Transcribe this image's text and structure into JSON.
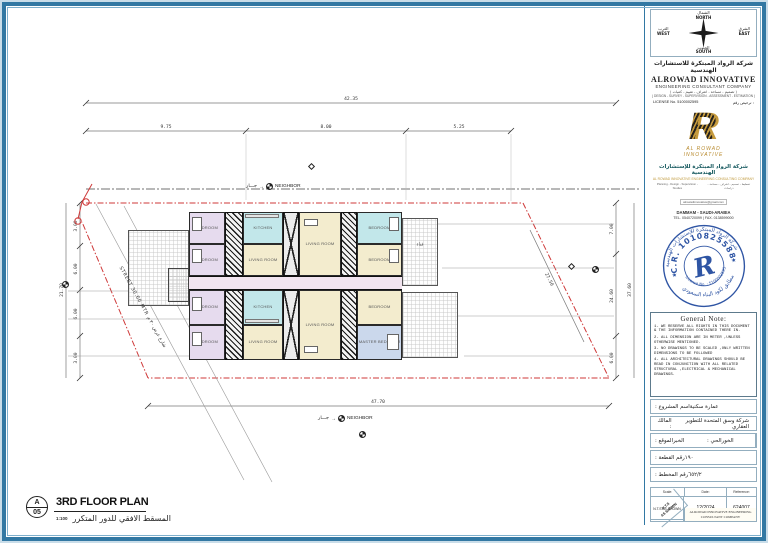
{
  "title_block": {
    "compass": {
      "north_ar": "الشمال",
      "north_en": "NORTH",
      "east_ar": "الشرق",
      "east_en": "EAST",
      "west_ar": "الغرب",
      "west_en": "WEST",
      "south_ar": "الجنوب",
      "south_en": "SOUTH"
    },
    "header": {
      "company_ar": "شركة الرواد المبتكرة للاستشارات الهندسية",
      "company_en": "ALROWAD INNOVATIVE",
      "company_type": "ENGINEERING CONSULTANT COMPANY",
      "services_ar": "( تصميم - مساحة - اشراف - تقييم - كميات )",
      "services_en": "( DESIGN - SURVEY - SUPERVISION - ASSESSMENT - ESTIMATION )",
      "license_en": "LICENSE No. 5100002595",
      "license_ar": "ترخيص رقم :"
    },
    "logo": {
      "letter": "R",
      "brand_line1": "AL ROWAD",
      "brand_line2": "INNOVATIVE"
    },
    "contact": {
      "company_ar": "شركة الرواد المبتكرة للإستشارات الهندسية",
      "company_en": "AL ROWAD INNOVATIVE ENGINEERING CONSULTING COMPANY",
      "services_en": "Planning - Design - Supervision - Studies",
      "services_ar": "تخطيط - تصميم - اشراف - مساحة - دراسات",
      "email": "alrowadinnovative@gmail.com",
      "city": "DAMMAM - SAUDI-ARABIA",
      "phone": "TEL. 0540720099   |   FAX. 0138599000"
    },
    "stamp": {
      "arc_top_ar": "شركة الرواد المبتكرة للإستشارات الهندسية",
      "cr": "C.R. 1010825588",
      "license": "License No. : 5100002595",
      "arc_bottom_ar": "مطابق لكود البناء السعودي",
      "letter": "R",
      "star": "★"
    },
    "general_note": {
      "title": "General Note:",
      "items": [
        "1- WE RESERVE ALL RIGHTS IN THIS DOCUMENT & THE INFORMATION CONTAINED THERE IN.",
        "2- ALL DIMENSION ARE IN METER ,UNLESS OTHERWISE MENTIONED.",
        "3- NO DRAWINGS TO BE SCALED ,ONLY WRITTEN DIMENSIONS TO BE FOLLOWED",
        "4- ALL ARCHITECTURAL DRAWINGS SHOULD BE READ IN CONJUNCTION WITH ALL RELATED STRUCTURAL ,ELECTRICAL & MECHANICAL DRAWINGS."
      ]
    },
    "fields": {
      "project_label": "اسم المشروع :",
      "project_value": "عمارة سكنية",
      "owner_label": "المالك :",
      "owner_value": "شركة وسق المتحدة للتطوير العقاري",
      "location_label": "الموقع :",
      "location_value": "الخبر",
      "district_label": "الحي :",
      "district_value": "الخور",
      "plot_label": "رقم القطعة :",
      "plot_value": "١٩٠",
      "plan_no_label": "رقم المخطط :",
      "plan_no_value": "٦٥٢/٢"
    },
    "table": {
      "scale_header": "Scale:",
      "date_header": "Date:",
      "ref_header": "Reference:",
      "scale_value": "N.T.S\nAS SHOWN",
      "date_value": "12/2024",
      "ref_value": "624007",
      "company": "ALROWAD INNOVATIVE ENGINEERING CONSULTANT COMPANY"
    }
  },
  "drawing": {
    "title": "3RD FLOOR PLAN",
    "title_ar": "المسقط الافقي للدور المتكرر",
    "scale": "1:100",
    "sheet_letter": "A",
    "sheet_number": "05",
    "neighbor_ar": "جـــار",
    "neighbor_en": "NEIGHBOR",
    "arrow": "→",
    "street_label": "STREET 30.00 MTR  شارع عرض ٣٠ م",
    "terrace_label": "فناء",
    "dims": {
      "top_total": "42.35",
      "top": [
        "9.75",
        "8.00",
        "5.25"
      ],
      "left_total": "21.70",
      "left": [
        "3.00",
        "6.00",
        "6.00",
        "3.00"
      ],
      "right": [
        "7.00",
        "24.60",
        "6.00"
      ],
      "right_total": "37.60",
      "bottom_total": "47.70",
      "diagonal": "27.50"
    },
    "rooms": [
      {
        "label": "BEDROOM"
      },
      {
        "label": "BEDROOM"
      },
      {
        "label": "KITCHEN"
      },
      {
        "label": "LIVING ROOM"
      },
      {
        "label": "LIVING ROOM"
      },
      {
        "label": "BEDROOM"
      },
      {
        "label": "BEDROOM"
      },
      {
        "label": "BEDROOM"
      },
      {
        "label": "BEDROOM"
      },
      {
        "label": "KITCHEN"
      },
      {
        "label": "LIVING ROOM"
      },
      {
        "label": "LIVING ROOM"
      },
      {
        "label": "BEDROOM"
      },
      {
        "label": "MASTER BEDROOM"
      }
    ],
    "colors": {
      "lavender": "#e6dbee",
      "cyan": "#c2e7ea",
      "cream": "#f3ecce",
      "blue": "#cbd8ec",
      "corridor": "#f1e4ef",
      "boundary_red": "#cf3a3a",
      "frame_blue": "#3278a3"
    }
  }
}
